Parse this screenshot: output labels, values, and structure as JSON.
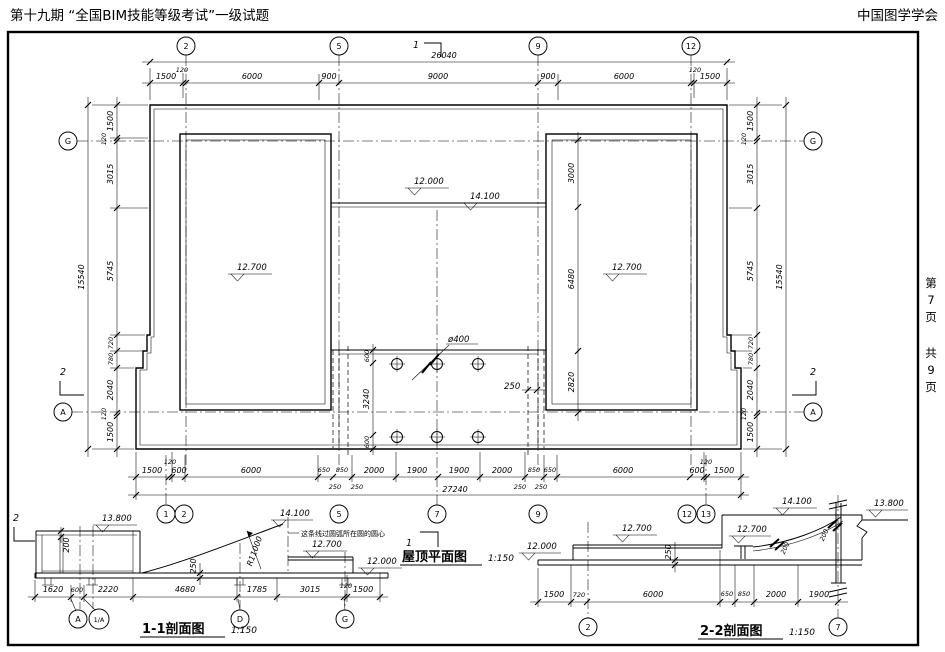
{
  "header": {
    "left": "第十九期 “全国BIM技能等级考试”一级试题",
    "right": "中国图学学会"
  },
  "page_info": {
    "chars": [
      "第",
      "7",
      "页",
      "共",
      "9",
      "页"
    ]
  },
  "plan": {
    "title": "屋顶平面图",
    "scale": "1:150",
    "overall_top": "26040",
    "overall_bottom": "27240",
    "overall_left": "15540",
    "overall_right": "15540",
    "top_dims": [
      "1500",
      "120",
      "6000",
      "900",
      "9000",
      "900",
      "6000",
      "120",
      "1500"
    ],
    "bottom_dims": [
      "1500",
      "120",
      "600",
      "6000",
      "650",
      "850",
      "2000",
      "1900",
      "1900",
      "2000",
      "850",
      "650",
      "6000",
      "600",
      "120",
      "1500"
    ],
    "bottom_sub_dims": [
      "250",
      "250",
      "250",
      "250"
    ],
    "left_dims": [
      "1500",
      "120",
      "3015",
      "5745",
      "720",
      "780",
      "2040",
      "120",
      "1500"
    ],
    "right_dims": [
      "1500",
      "120",
      "3015",
      "5745",
      "720",
      "780",
      "2040",
      "120",
      "1500"
    ],
    "tower_dims": [
      "3000",
      "6480",
      "2820"
    ],
    "portico_dims": [
      "600",
      "3240",
      "600"
    ],
    "column_diameter": "ø400",
    "wall_offset": "250",
    "elev_center": "12.000",
    "elev_canopy": "14.100",
    "elev_left_tower": "12.700",
    "elev_right_tower": "12.700",
    "grids_top": [
      "2",
      "5",
      "9",
      "12"
    ],
    "grids_bottom": [
      "1",
      "2",
      "5",
      "7",
      "9",
      "12",
      "13"
    ],
    "grid_left_g": "G",
    "grid_left_a": "A",
    "grid_right_g": "G",
    "grid_right_a": "A",
    "section1_mark": "1",
    "section2_mark": "2"
  },
  "section_1_1": {
    "title": "1-1剖面图",
    "scale": "1:150",
    "elev_parapet": "13.800",
    "elev_top": "14.100",
    "elev_roof": "12.700",
    "elev_low": "12.000",
    "radius": "R11000",
    "note": "这条线过圆弧所在圆的圆心",
    "parapet_dim": "200",
    "slab_dim": "250",
    "bottom_dims": [
      "1620",
      "600",
      "2220",
      "4680",
      "1785",
      "3015",
      "120",
      "1500"
    ],
    "grids": [
      "A",
      "1/A",
      "D",
      "G"
    ]
  },
  "section_2_2": {
    "title": "2-2剖面图",
    "scale": "1:150",
    "elev_left": "12.000",
    "elev_left_roof": "12.700",
    "elev_top": "14.100",
    "elev_arch": "12.700",
    "elev_right": "13.800",
    "slab_dim": "250",
    "arch_dim_a": "200",
    "arch_dim_b": "200",
    "bottom_dims": [
      "1500",
      "720",
      "6000",
      "650",
      "850",
      "2000",
      "1900"
    ],
    "grids": [
      "2",
      "7"
    ]
  }
}
